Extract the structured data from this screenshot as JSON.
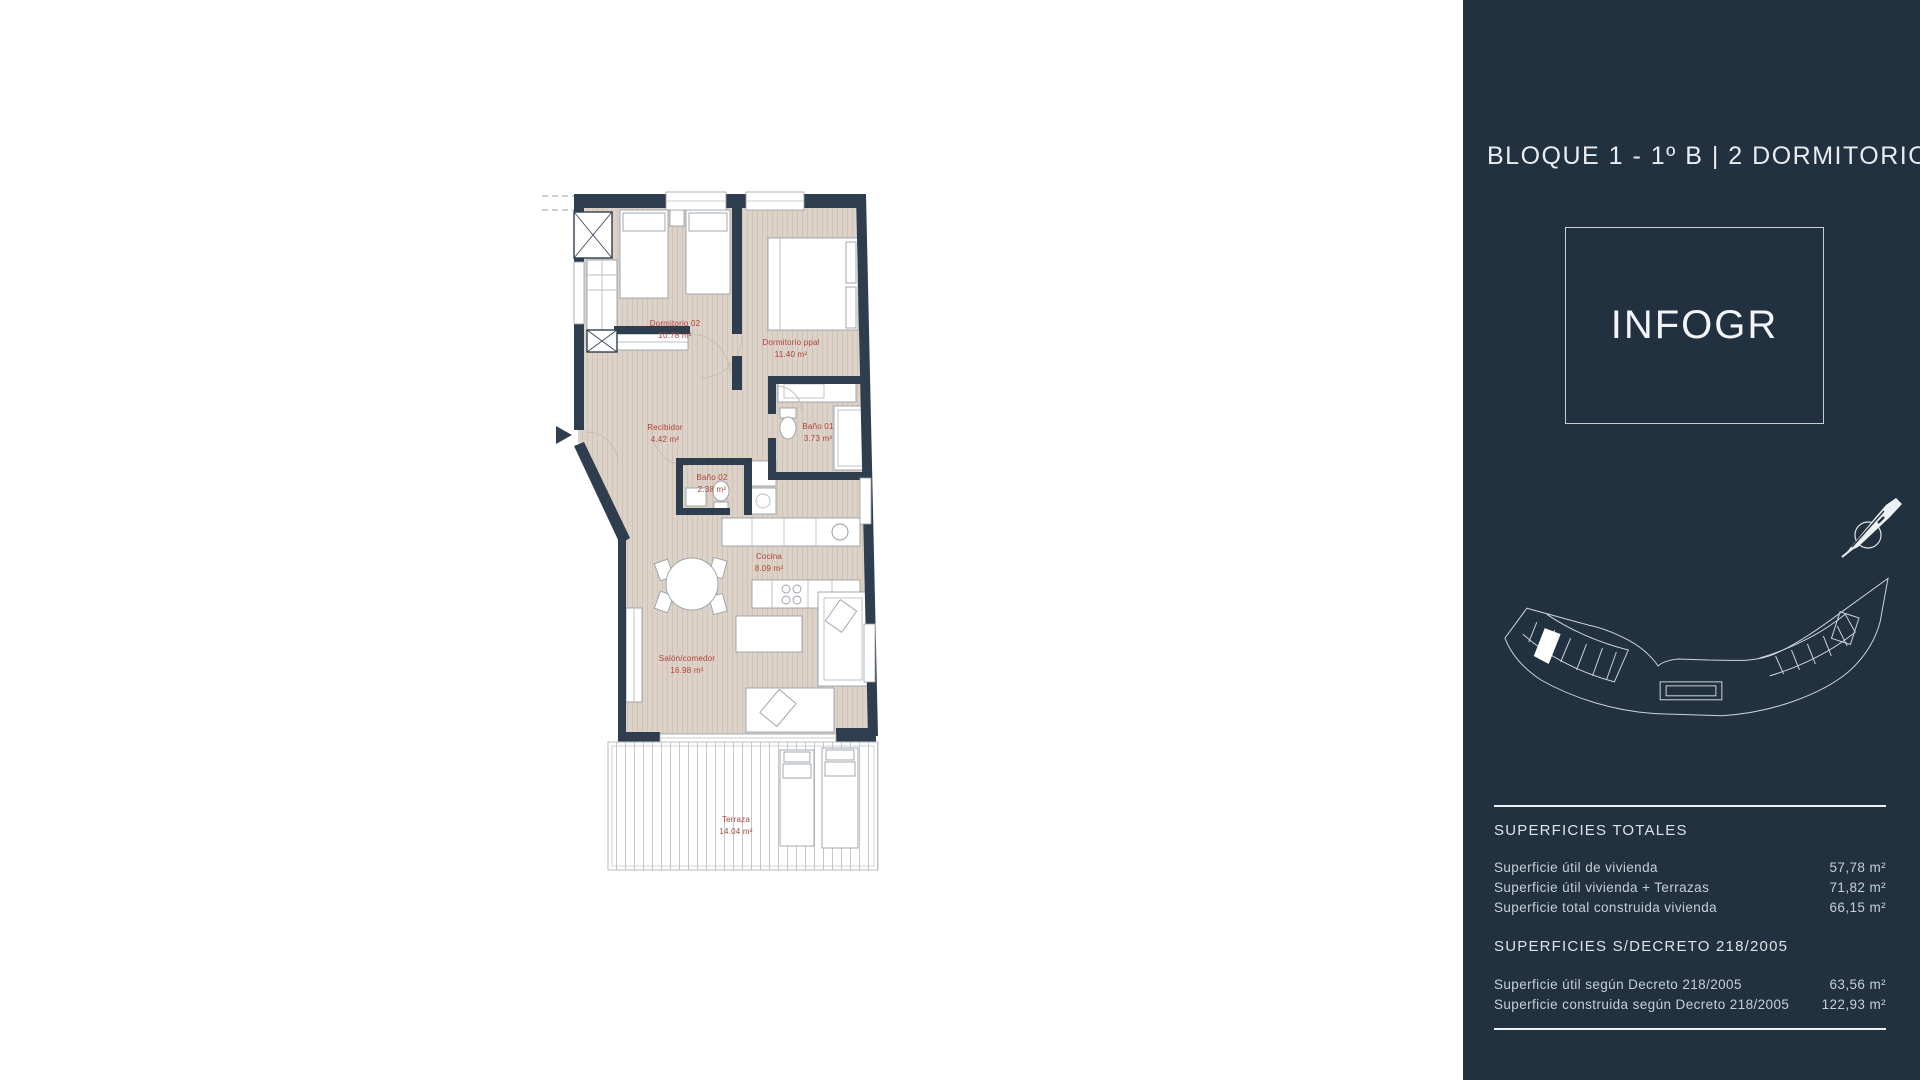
{
  "floorplan": {
    "label_color": "#ac4238",
    "wall_color": "#2f3e4e",
    "floor_color": "#ddd2c8",
    "rooms": [
      {
        "name": "Dormitorio 02",
        "area": "10.78 m²"
      },
      {
        "name": "Dormitorio ppal",
        "area": "11.40 m²"
      },
      {
        "name": "Recibidor",
        "area": "4.42 m²"
      },
      {
        "name": "Baño 01",
        "area": "3.73 m²"
      },
      {
        "name": "Baño 02",
        "area": "2.38 m²"
      },
      {
        "name": "Cocina",
        "area": "8.09 m²"
      },
      {
        "name": "Salón/comedor",
        "area": "16.98 m²"
      },
      {
        "name": "Terraza",
        "area": "14.04 m²"
      }
    ]
  },
  "sidebar": {
    "background_color": "#223140",
    "title": "BLOQUE 1 - 1º B | 2 DORMITORIOS",
    "logo_placeholder": "INFOGR",
    "sections": [
      {
        "heading": "SUPERFICIES TOTALES",
        "rows": [
          {
            "label": "Superficie útil de vivienda",
            "value": "57,78 m²"
          },
          {
            "label": "Superficie útil vivienda + Terrazas",
            "value": "71,82 m²"
          },
          {
            "label": "Superficie total construida vivienda",
            "value": "66,15 m²"
          }
        ]
      },
      {
        "heading": "SUPERFICIES S/DECRETO 218/2005",
        "rows": [
          {
            "label": "Superficie útil según Decreto 218/2005",
            "value": "63,56 m²"
          },
          {
            "label": "Superficie construida según Decreto 218/2005",
            "value": "122,93 m²"
          }
        ]
      }
    ]
  }
}
